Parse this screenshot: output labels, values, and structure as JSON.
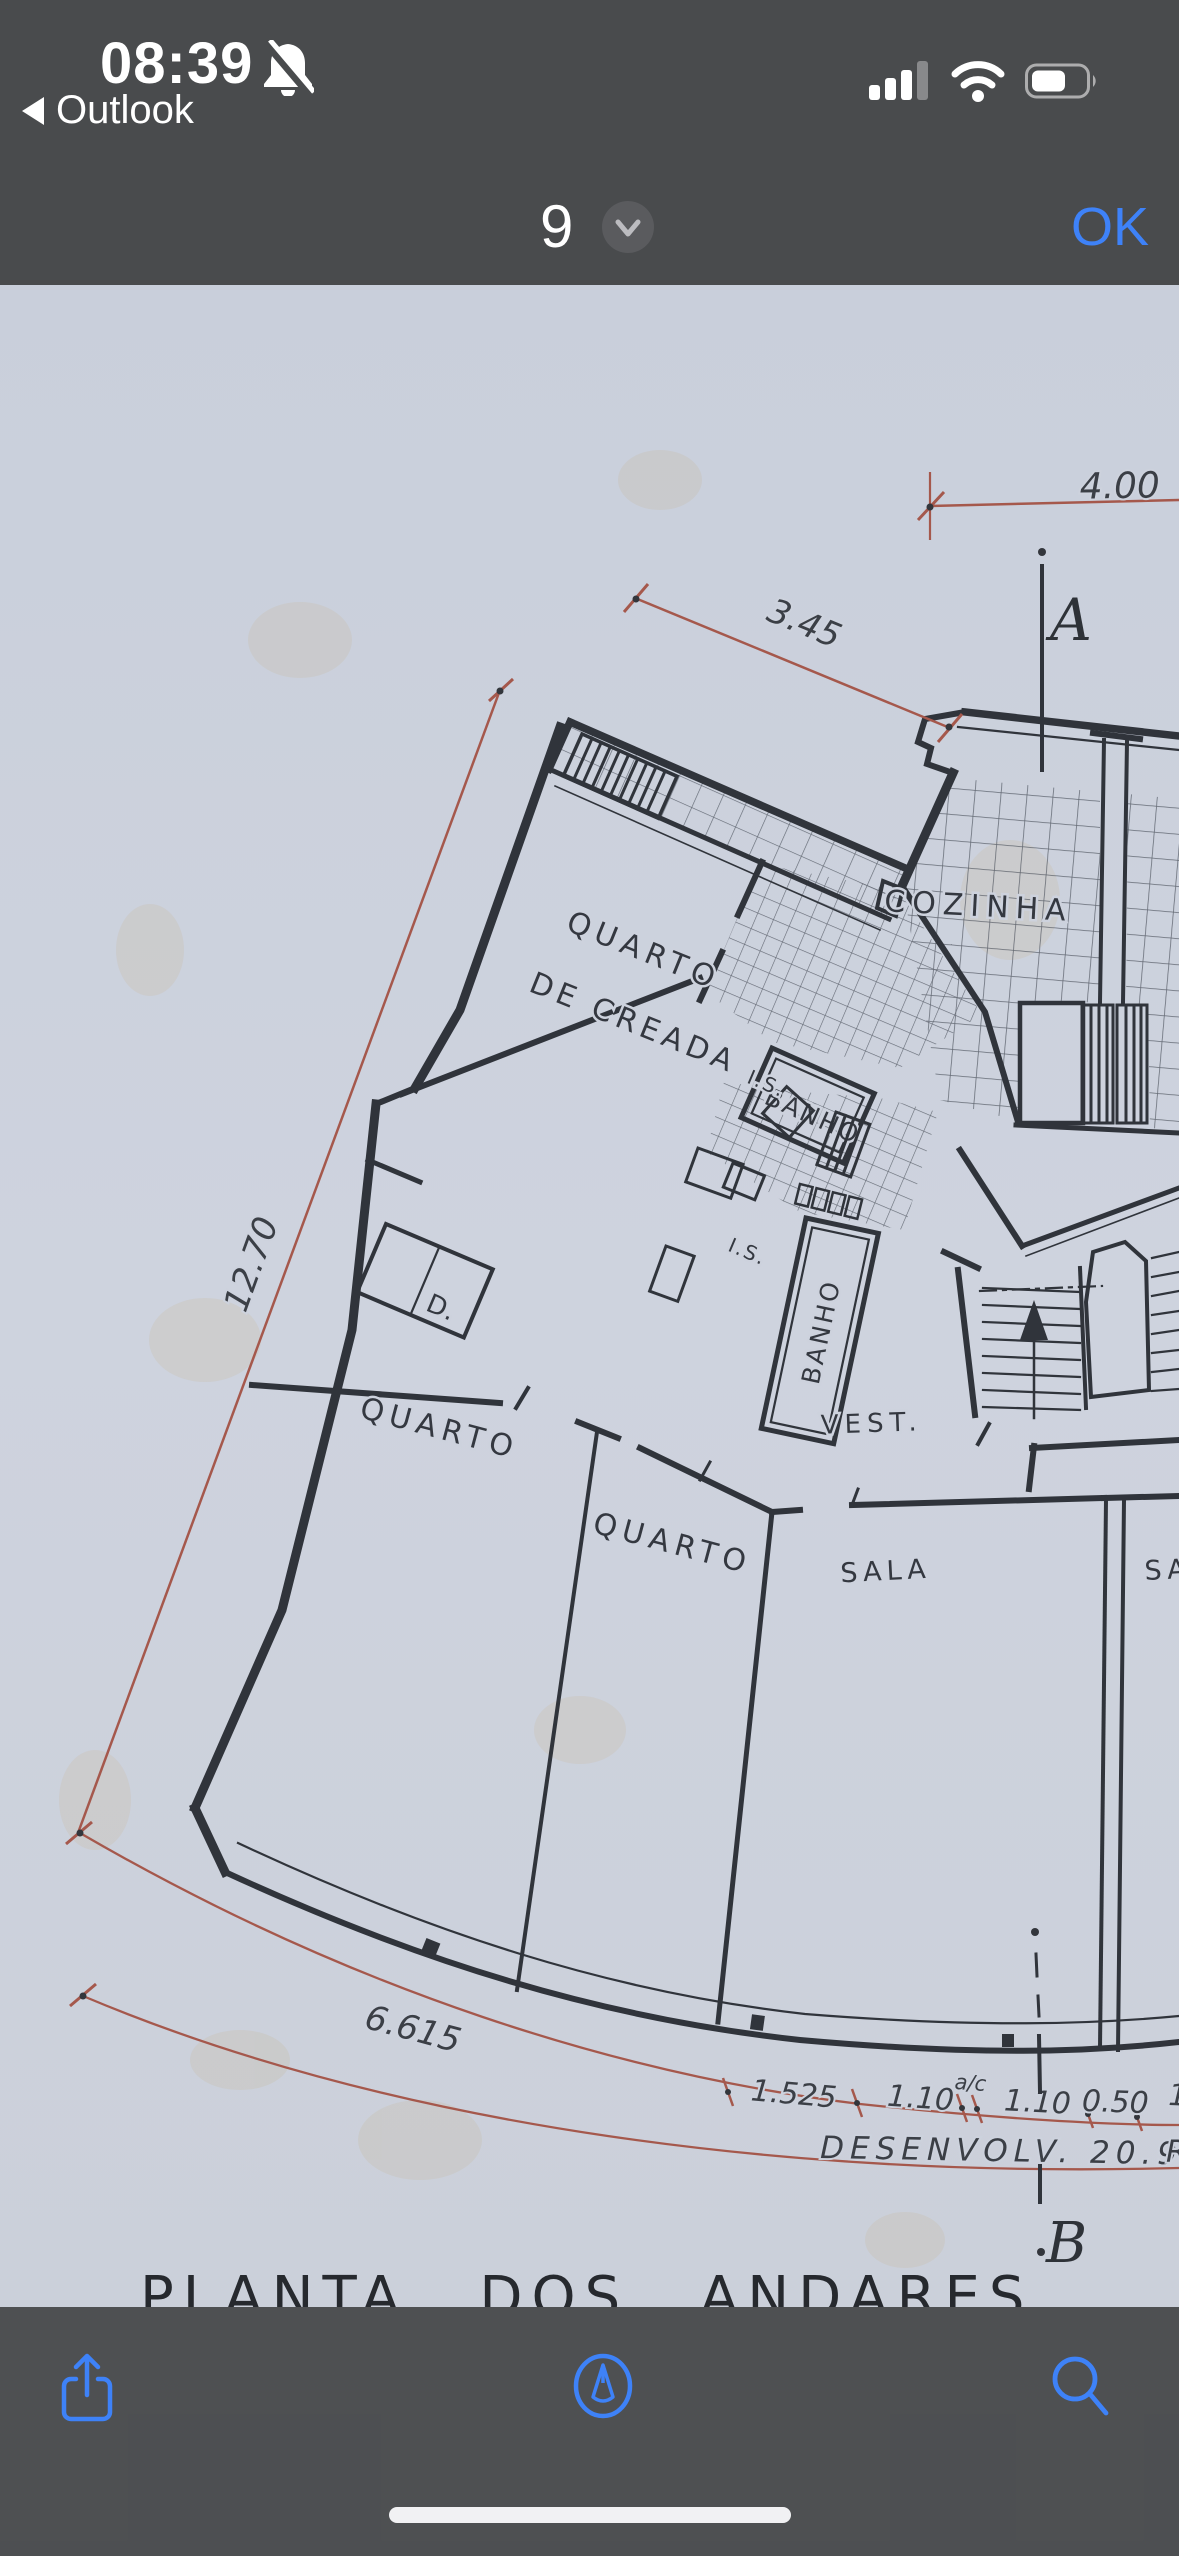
{
  "status_bar": {
    "time": "08:39",
    "back_to_app": "Outlook"
  },
  "nav_bar": {
    "page_indicator": "9",
    "confirm_label": "OK"
  },
  "document": {
    "title": "PLANTA DOS ANDARES",
    "rooms": {
      "maid1": "QUARTO",
      "maid2": "DE CREADA",
      "bath1": "BANHO",
      "wc1": "I.S.",
      "wc2": "I.S.",
      "kitchen": "COZINHA",
      "closet": "D.",
      "bed1": "QUARTO",
      "bed2": "QUARTO",
      "vest": "VEST.",
      "bath2": "BANHO",
      "living1": "SALA",
      "living2": "SA"
    },
    "dims": {
      "top": "4.00",
      "diag": "3.45",
      "left": "12.70",
      "arc": "6.615",
      "s1": "1.525",
      "s2": "1.10",
      "sac": "a/c",
      "s3": "1.10",
      "s4": "0.50",
      "s5": "1.",
      "developed": "DESENVOLV. 20.98",
      "partial_r": "R"
    },
    "sections": {
      "a": "A",
      "b": "B"
    }
  },
  "colors": {
    "accent_blue": "#3e82f8",
    "chrome_gray": "#494b4d",
    "paper": "#cdd2dd",
    "ink": "#30343b",
    "dim_red": "#a5584c"
  },
  "toolbar_icons": [
    "share-icon",
    "markup-icon",
    "search-icon"
  ]
}
